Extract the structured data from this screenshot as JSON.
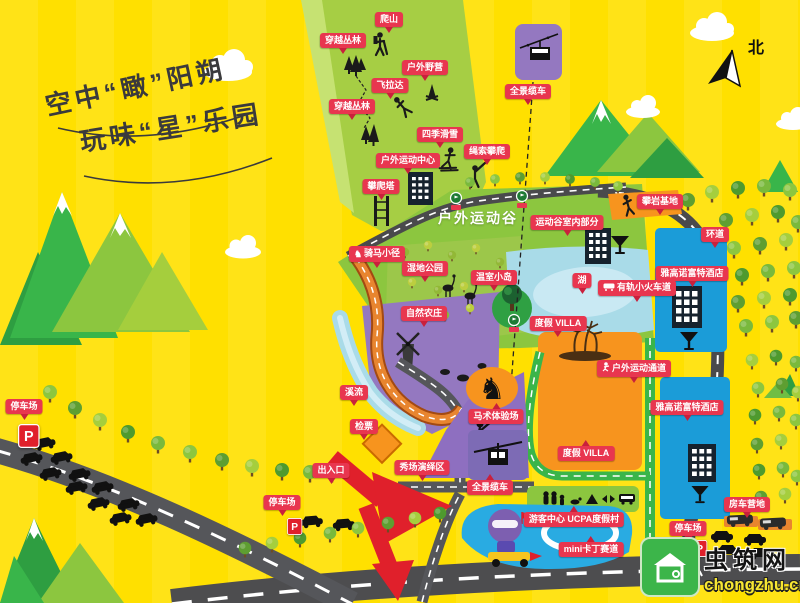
{
  "title": {
    "line1": "空中“瞰”阳朔",
    "line2": "玩味“星”乐园"
  },
  "compass": {
    "north_label": "北"
  },
  "area_labels": {
    "sports_valley": "户外运动谷"
  },
  "parking": {
    "sign": "P"
  },
  "watermark": {
    "site_name": "虫筑网",
    "site_url": "chongzhu.cn"
  },
  "colors": {
    "background": "#FFE000",
    "label_red": "#E8364F",
    "slope_green": "#A6CE44",
    "field_green": "#8CC63F",
    "lake_blue": "#A9DBE8",
    "building_blue": "#1B9CD8",
    "villa_orange": "#F7941E",
    "farm_purple": "#9478C0",
    "road_gray": "#4D4D4F",
    "green_road": "#3AB54A",
    "track_orange": "#E8852F",
    "arrow_red": "#E0202B",
    "watermark_green": "#3CB54A"
  },
  "map_labels": [
    {
      "id": "hiking",
      "text": "爬山",
      "x": 389,
      "y": 12
    },
    {
      "id": "jungle-crossing-1",
      "text": "穿越丛林",
      "x": 343,
      "y": 33
    },
    {
      "id": "outdoor-camping",
      "text": "户外野营",
      "x": 425,
      "y": 60
    },
    {
      "id": "via-ferrata",
      "text": "飞拉达",
      "x": 390,
      "y": 78
    },
    {
      "id": "jungle-crossing-2",
      "text": "穿越丛林",
      "x": 352,
      "y": 99
    },
    {
      "id": "four-season-ski",
      "text": "四季滑雪",
      "x": 440,
      "y": 127
    },
    {
      "id": "rope-climbing",
      "text": "绳索攀爬",
      "x": 487,
      "y": 144
    },
    {
      "id": "outdoor-sports-center",
      "text": "户外运动中心",
      "x": 408,
      "y": 153
    },
    {
      "id": "climbing-tower",
      "text": "攀爬塔",
      "x": 381,
      "y": 179
    },
    {
      "id": "panorama-cablecar-top",
      "text": "全景缆车",
      "x": 528,
      "y": 84
    },
    {
      "id": "rock-climbing-base",
      "text": "攀岩基地",
      "x": 660,
      "y": 194
    },
    {
      "id": "ring-road",
      "text": "环道",
      "x": 715,
      "y": 227
    },
    {
      "id": "novotel-hotel-1",
      "text": "雅高诺富特酒店",
      "x": 692,
      "y": 266
    },
    {
      "id": "horse-riding-trail",
      "text": "骑马小径",
      "x": 377,
      "y": 246,
      "icon": "horse"
    },
    {
      "id": "wetland-park",
      "text": "湿地公园",
      "x": 425,
      "y": 261
    },
    {
      "id": "greenhouse-island",
      "text": "温室小岛",
      "x": 494,
      "y": 270
    },
    {
      "id": "lake",
      "text": "湖",
      "x": 582,
      "y": 273
    },
    {
      "id": "mini-train-track",
      "text": "有轨小火车道",
      "x": 637,
      "y": 280,
      "icon": "train"
    },
    {
      "id": "valley-indoor-part",
      "text": "运动谷室内部分",
      "x": 567,
      "y": 215
    },
    {
      "id": "natural-farm",
      "text": "自然农庄",
      "x": 424,
      "y": 306
    },
    {
      "id": "holiday-villa-1",
      "text": "度假 VILLA",
      "x": 558,
      "y": 316
    },
    {
      "id": "holiday-villa-2",
      "text": "度假 VILLA",
      "x": 586,
      "y": 446,
      "tail": "up"
    },
    {
      "id": "outdoor-sports-passage",
      "text": "户外运动通道",
      "x": 634,
      "y": 360,
      "icon": "runner"
    },
    {
      "id": "stream",
      "text": "溪流",
      "x": 354,
      "y": 385
    },
    {
      "id": "ticket-check",
      "text": "检票",
      "x": 364,
      "y": 419
    },
    {
      "id": "entrance-exit",
      "text": "出入口",
      "x": 331,
      "y": 463
    },
    {
      "id": "parking-left",
      "text": "停车场",
      "x": 24,
      "y": 399
    },
    {
      "id": "parking-mid",
      "text": "停车场",
      "x": 282,
      "y": 495
    },
    {
      "id": "equestrian-ground",
      "text": "马术体验场",
      "x": 496,
      "y": 409,
      "tail": "up"
    },
    {
      "id": "show-performance-area",
      "text": "秀场演绎区",
      "x": 422,
      "y": 460
    },
    {
      "id": "panorama-cablecar-bottom",
      "text": "全景缆车",
      "x": 490,
      "y": 480,
      "tail": "up"
    },
    {
      "id": "visitor-center",
      "text": "游客中心 UCPA度假村",
      "x": 574,
      "y": 512,
      "tail": "up"
    },
    {
      "id": "mini-kart-track",
      "text": "mini卡丁赛道",
      "x": 591,
      "y": 542,
      "tail": "up"
    },
    {
      "id": "rv-camp",
      "text": "房车营地",
      "x": 747,
      "y": 497
    },
    {
      "id": "parking-right",
      "text": "停车场",
      "x": 688,
      "y": 521
    },
    {
      "id": "novotel-hotel-2",
      "text": "雅高诺富特酒店",
      "x": 687,
      "y": 400
    }
  ]
}
